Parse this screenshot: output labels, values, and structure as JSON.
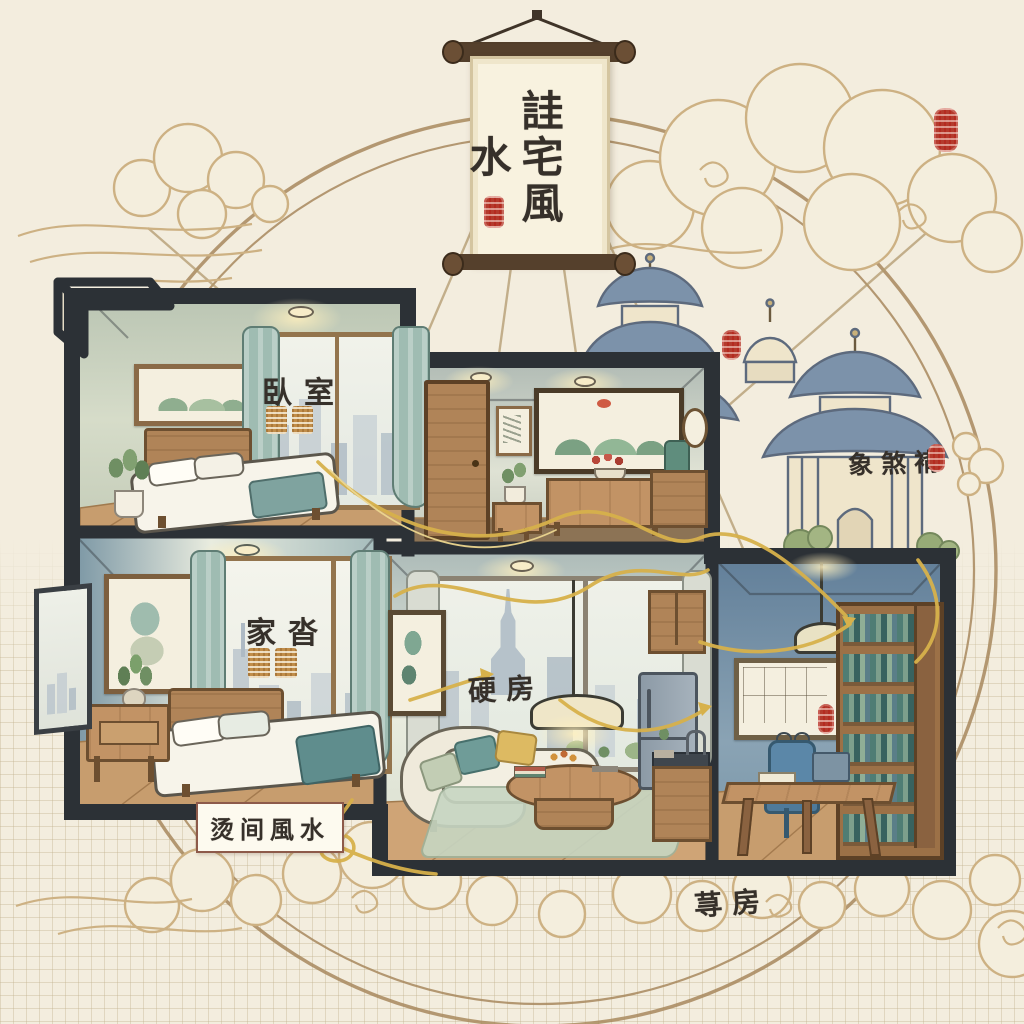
{
  "scene": {
    "type": "illustration",
    "style": "chinese-watercolor-home-fengshui-cutaway",
    "background_color": "#f3edde"
  },
  "banner": {
    "title": "詿宅風水",
    "orientation": "vertical-scroll"
  },
  "labels": {
    "bedroom_top": "臥室",
    "bedroom_bottom": "家沓",
    "living_kitchen": "硬房",
    "room_fengshui_box": "烫间風水",
    "study": "荨房",
    "pagoda_area": "象煞褙"
  },
  "rooms": [
    {
      "name": "bedroom-upper",
      "label_key": "bedroom_top",
      "furniture": [
        "bed",
        "plant",
        "landscape-painting",
        "window-city-view",
        "teal-curtains",
        "ceiling-light"
      ]
    },
    {
      "name": "entry-hall",
      "label_key": null,
      "furniture": [
        "wood-door",
        "mountain-painting",
        "console-table-red-flowers",
        "plant-side-table",
        "lamp-cabinet",
        "wall-clock",
        "ceiling-lights"
      ]
    },
    {
      "name": "bedroom-lower",
      "label_key": "bedroom_bottom",
      "furniture": [
        "bed",
        "nightstand-plant",
        "portrait-painting",
        "window-city-view",
        "teal-curtains",
        "open-shutter"
      ]
    },
    {
      "name": "living-kitchen",
      "label_key": "living_kitchen",
      "furniture": [
        "curved-sofa",
        "coffee-table",
        "rug",
        "pendant-lamp",
        "large-window-skyline",
        "abstract-painting",
        "fridge",
        "sink-counter",
        "wall-cabinet"
      ]
    },
    {
      "name": "study",
      "label_key": "study",
      "furniture": [
        "bookshelf",
        "desk-laptop",
        "office-chair",
        "pendant-lamp",
        "framed-chart",
        "wall-seal"
      ]
    }
  ],
  "decorations": {
    "red_seal_stamps": 6,
    "orange_seal_blocks": 4,
    "qi_line_color": "#d7b14b",
    "bagua_circle_color": "#a8895e",
    "pagoda_roof_color": "#7c92aa",
    "house_wall_color": "#2c3136",
    "cloud_outline_color": "#cdb183",
    "grid_paper": true
  },
  "icons": {
    "red-seal-stamp": "rounded red stamp with carved glyphs",
    "orange-seal-block": "small square bronze seal",
    "cloud-motif": "spiral auspicious cloud",
    "qi-flow-line": "golden energy curve",
    "pagoda": "blue-roof tiered tower",
    "glasses-icon": "small spectacles on study wall"
  }
}
